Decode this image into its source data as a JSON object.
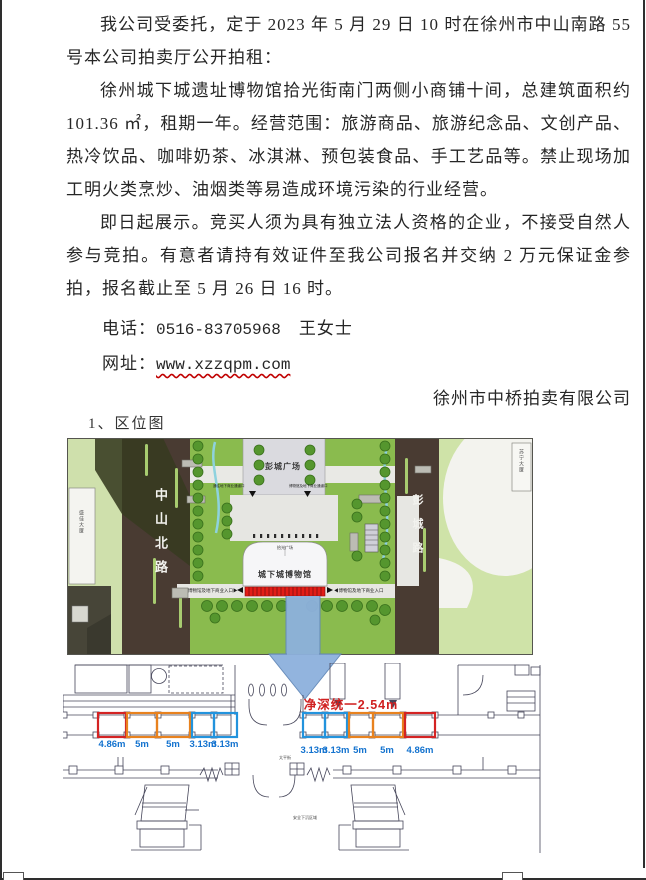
{
  "document": {
    "para1": "我公司受委托，定于 2023 年 5 月 29 日 10 时在徐州市中山南路 55 号本公司拍卖厅公开拍租：",
    "para2": "徐州城下城遗址博物馆拾光街南门两侧小商铺十间，总建筑面积约 101.36 ㎡，租期一年。经营范围：旅游商品、旅游纪念品、文创产品、热冷饮品、咖啡奶茶、冰淇淋、预包装食品、手工艺品等。禁止现场加工明火类烹炒、油烟类等易造成环境污染的行业经营。",
    "para3": "即日起展示。竞买人须为具有独立法人资格的企业，不接受自然人参与竞拍。有意者请持有效证件至我公司报名并交纳 2 万元保证金参拍，报名截止至 5 月 26 日 16 时。",
    "phone_label": "电话：",
    "phone_number": "0516-83705968",
    "phone_contact": "王女士",
    "web_label": "网址：",
    "web_url": "www.xzzqpm.com",
    "signature": "徐州市中桥拍卖有限公司",
    "section1_title": "1、区位图"
  },
  "site_map": {
    "road_left": "中山北路",
    "road_right": "彭城路",
    "plaza": "彭城广场",
    "building_left": "盛佳大厦",
    "building_top_right": "苏宁大厦",
    "museum": "城下城博物馆",
    "museum_plaza": "拾光广场",
    "entrance_left": "通往地下商业通道口",
    "entrance_right": "博物馆及地下商业通道口",
    "side_entry_left": "博物馆及地下商业入口▶",
    "side_entry_right": "◀博物馆及地下商业入口"
  },
  "floor_plan": {
    "depth_note": "净深统一2.54m",
    "left_shops": [
      {
        "width": "4.86m",
        "color": "red"
      },
      {
        "width": "5m",
        "color": "orange"
      },
      {
        "width": "5m",
        "color": "orange"
      },
      {
        "width": "3.13m",
        "color": "blue"
      },
      {
        "width": "3.13m",
        "color": "blue"
      }
    ],
    "right_shops": [
      {
        "width": "3.13m",
        "color": "blue"
      },
      {
        "width": "3.13m",
        "color": "blue"
      },
      {
        "width": "5m",
        "color": "orange"
      },
      {
        "width": "5m",
        "color": "orange"
      },
      {
        "width": "4.86m",
        "color": "red"
      }
    ],
    "street_label": "太平街",
    "area_label": "安全下沉区域"
  },
  "colors": {
    "c_red": "#d42323",
    "c_orange": "#e8821e",
    "c_blue": "#2293dd",
    "c_dim": "#1473cf",
    "c_depth": "#d02020",
    "c_strip": "#e31d17"
  }
}
